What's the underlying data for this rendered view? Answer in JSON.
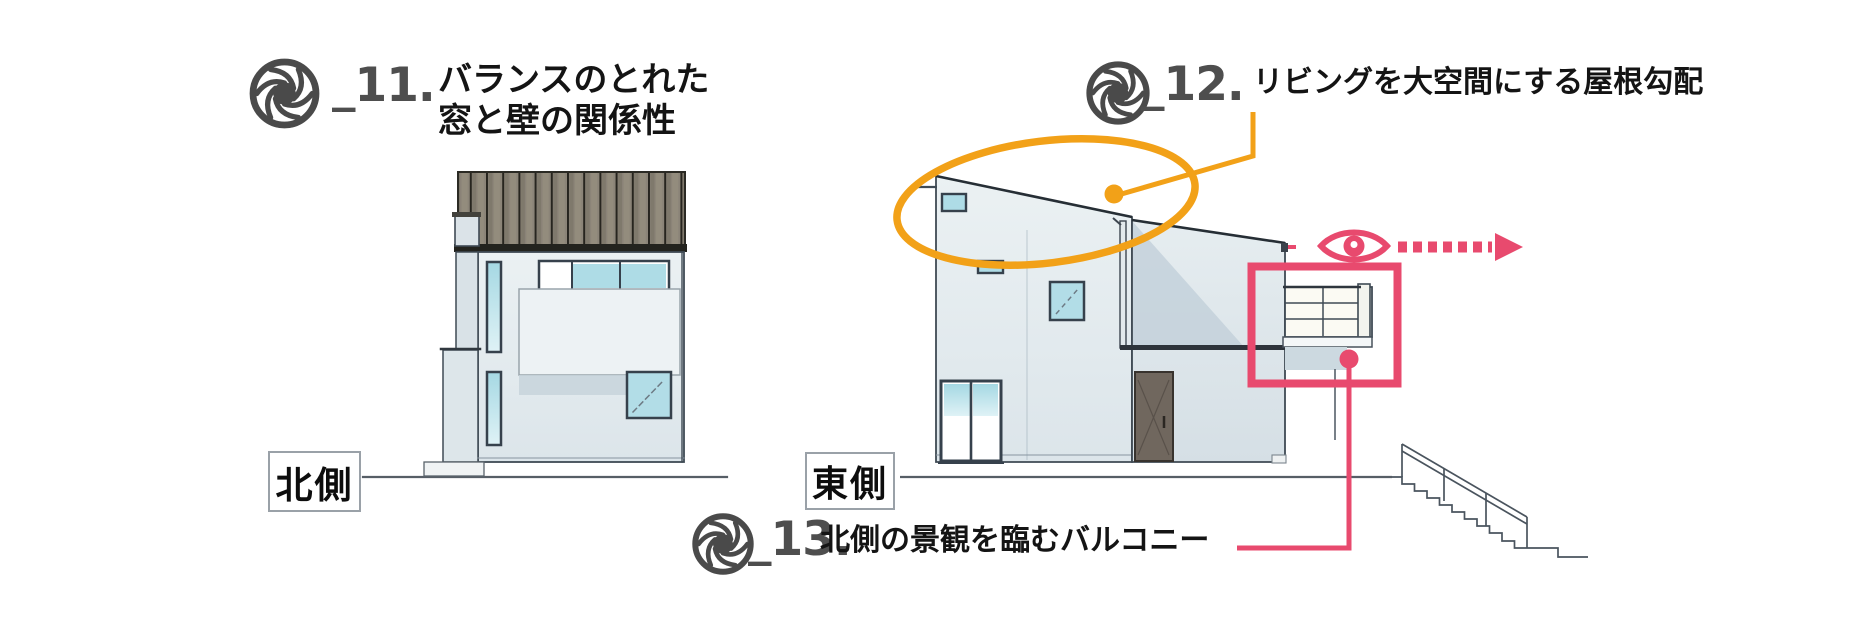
{
  "annotations": {
    "item11": {
      "icon": "aperture-icon",
      "id_label": "_11.",
      "line1": "バランスのとれた",
      "line2": "窓と壁の関係性"
    },
    "item12": {
      "icon": "aperture-icon",
      "id_label": "_12.",
      "text": "リビングを大空間にする屋根勾配"
    },
    "item13": {
      "icon": "aperture-icon",
      "id_label": "_13.",
      "text": "北側の景観を臨むバルコニー"
    }
  },
  "elevation_labels": {
    "north": "北側",
    "east": "東側"
  },
  "markers": {
    "roof_highlight": "orange-ellipse-highlight",
    "balcony_highlight": "pink-rectangle-highlight",
    "view_direction": "eye-icon-with-dotted-arrow-right"
  },
  "colors": {
    "accent_orange": "#F2A118",
    "accent_pink": "#E84A6E",
    "annotation_number_gray": "#4E4E4E",
    "text_black": "#141414",
    "line_dark": "#3F4A54",
    "wall_light": "#E8EEF1",
    "window_teal": "#AEDCE6",
    "roof_gray_brown": "#8B8478",
    "door_gray_brown": "#6F675E"
  }
}
